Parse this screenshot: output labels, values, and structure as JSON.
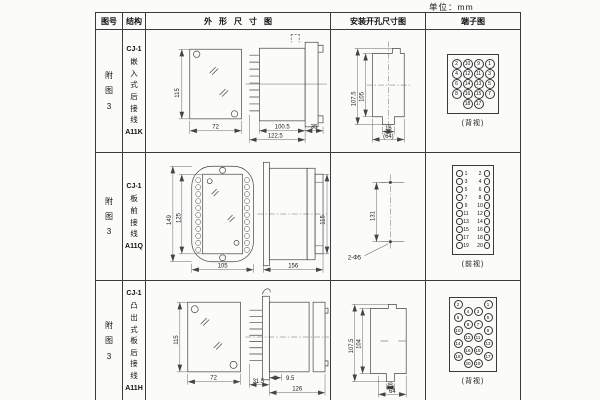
{
  "unit_label": "单位：mm",
  "header": {
    "col_fig": "图号",
    "col_struct": "结构",
    "col_outline": "外形尺寸图",
    "col_install": "安装开孔尺寸图",
    "col_terminal": "端子图"
  },
  "rows": [
    {
      "fig_no": "附图3",
      "structure": {
        "model": "CJ-1",
        "desc": "嵌入式后接线",
        "code": "A11K"
      },
      "outline": {
        "height": "115",
        "width": "72",
        "body_depth": "100.5",
        "total_depth": "122.5",
        "flange": "35"
      },
      "install": {
        "v_outer": "107.5",
        "v_inner": "105",
        "h_inner": "16",
        "h_outer": "(64)"
      },
      "terminal": {
        "style": "grid4",
        "label": "(背视)",
        "rows": [
          [
            "2",
            "10",
            "9",
            "1"
          ],
          [
            "4",
            "12",
            "11",
            "3"
          ],
          [
            "6",
            "14",
            "13",
            "5"
          ],
          [
            "8",
            "16",
            "15",
            "7"
          ],
          [
            null,
            "18",
            "17",
            null
          ]
        ]
      }
    },
    {
      "fig_no": "附图3",
      "structure": {
        "model": "CJ-1",
        "desc": "板前接线",
        "code": "A11Q"
      },
      "outline": {
        "height": "149",
        "window_height": "125",
        "width": "105",
        "depth": "156",
        "side_height": "115"
      },
      "install": {
        "hole_span": "131",
        "hole_note": "2-Φ5"
      },
      "terminal": {
        "style": "pairs",
        "label": "(前视)",
        "rows": [
          [
            "1",
            "2"
          ],
          [
            "3",
            "4"
          ],
          [
            "5",
            "6"
          ],
          [
            "7",
            "8"
          ],
          [
            "9",
            "10"
          ],
          [
            "11",
            "12"
          ],
          [
            "13",
            "14"
          ],
          [
            "15",
            "16"
          ],
          [
            "17",
            "18"
          ],
          [
            "19",
            "20"
          ]
        ]
      }
    },
    {
      "fig_no": "附图3",
      "structure": {
        "model": "CJ-1",
        "desc": "凸出式板后接线",
        "code": "A11H"
      },
      "outline": {
        "height": "115",
        "width": "72",
        "fin_depth": "31.5",
        "offset": "9.5",
        "body_depth": "126"
      },
      "install": {
        "v_outer": "107.5",
        "v_inner": "104",
        "h_inner": "16",
        "h_outer": "64"
      },
      "terminal": {
        "style": "zigzag",
        "label": "(背视)",
        "rows": [
          [
            "2",
            null,
            null,
            "1"
          ],
          [
            null,
            "4",
            "3",
            null
          ],
          [
            "6",
            null,
            null,
            "5"
          ],
          [
            null,
            "8",
            "7",
            null
          ],
          [
            "10",
            null,
            null,
            "9"
          ],
          [
            null,
            "12",
            "11",
            null
          ],
          [
            "14",
            null,
            null,
            "13"
          ],
          [
            null,
            "16",
            "15",
            null
          ],
          [
            "18",
            null,
            null,
            "17"
          ],
          [
            null,
            "20",
            "19",
            null
          ]
        ]
      }
    }
  ]
}
